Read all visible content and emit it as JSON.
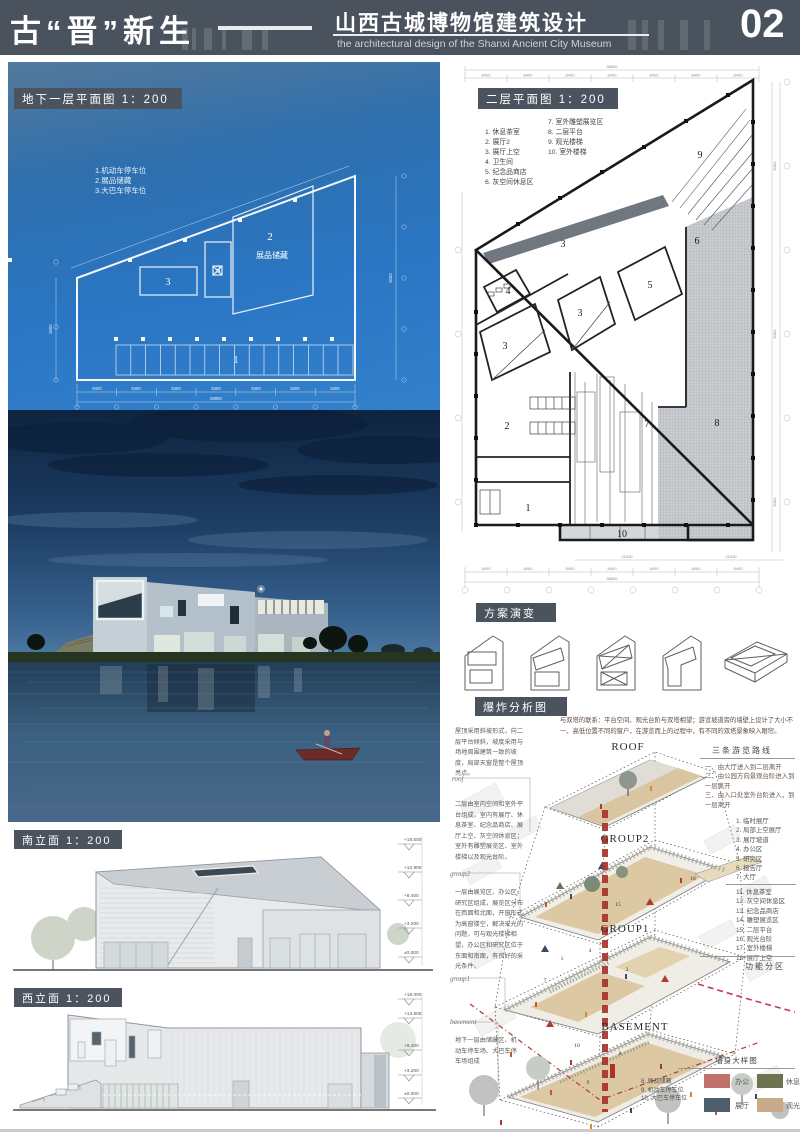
{
  "header": {
    "title_left": "古“晋”新生",
    "title_cn": "山西古城博物馆建筑设计",
    "title_en": "the architectural design of the Shanxi Ancient City Museum",
    "page_no": "02"
  },
  "basement_plan": {
    "label": "地下一层平面图 1：200",
    "legend": [
      "1.机动车停车位",
      "2.展品储藏",
      "3.大巴车停车位"
    ],
    "room2_name": "展品储藏",
    "numbers": {
      "r1": "1",
      "r2": "2",
      "r3a": "3",
      "r3b": "3"
    },
    "dims": {
      "bay": "8400",
      "total": "58800"
    }
  },
  "second_plan": {
    "label": "二层平面图 1：200",
    "legend_left": [
      "1. 休息茶室",
      "2. 展厅2",
      "3. 展厅上空",
      "4. 卫生间",
      "5. 纪念品商店",
      "6. 灰空间休息区"
    ],
    "legend_right": [
      "7. 室外雕塑展览区",
      "8. 二层平台",
      "9. 观光楼梯",
      "10. 室外楼梯"
    ],
    "numbers": {
      "n1": "1",
      "n2": "2",
      "n3a": "3",
      "n3b": "3",
      "n3c": "3",
      "n4": "4",
      "n5": "5",
      "n6": "6",
      "n7": "7",
      "n8": "8",
      "n9": "9",
      "n10": "10"
    },
    "dims": {
      "bay": "8400",
      "total": "58800",
      "sub": "21000"
    }
  },
  "evolution": {
    "label": "方案演变"
  },
  "explosion": {
    "label": "爆炸分析图",
    "intro": "与双塔的联系：平台空间、观光台阶与双塔相望；游览坡道旁的墙壁上设计了大小不一、高低位置不同的窗户，在游览而上的过程中，有不同的双塔景象映入眼帘。",
    "notes": {
      "roof": "屋顶采用斜坡形式，向二层平台倾斜，坡度采用与场地周围建筑一致的坡度，局部天窗是整个屋顶亮点。",
      "group2": "二层由室内空间和室外平台组成，室内有展厅、休息茶室、纪念品商店、展厅上空、灰空间休息区；室外有雕塑展览区、室外楼梯以及观光台阶。",
      "group1": "一层由展览区、办公区、研究区组成，展览区分布在西面和北面，开窗形式为高窗镂空，解决采光的问题，可与观光楼梯相望，办公区和研究区位于东面和南面，有良好的采光条件。",
      "basement": "地下一层由储藏区、机动车停车场、大巴车停车场组成"
    },
    "tags": {
      "roof": "roof",
      "group2": "group2",
      "group1": "group1",
      "basement": "basement"
    },
    "layers": [
      "ROOF",
      "GROUP2",
      "GROUP1",
      "BASEMENT"
    ],
    "routes": {
      "title": "三条游览路线",
      "items": [
        "一、由大厅进入到二层离开",
        "二、由公园方向景观台阶进入到一层离开",
        "三、由入口处室外台阶进入，到一层离开"
      ]
    },
    "zones": {
      "group_a": [
        "1. 临时展厅",
        "2. 局部上空展厅",
        "3. 展厅坡道",
        "4. 办公区",
        "5. 研究区",
        "6. 报告厅",
        "7. 大厅"
      ],
      "group_b": [
        "11. 休息茶室",
        "12. 灰空间休息区",
        "13. 纪念品商店",
        "14. 雕塑展览区",
        "15. 二层平台",
        "16. 观光台阶",
        "17. 室外楼梯",
        "18. 展厅上空"
      ],
      "group_c": [
        "8. 展品储藏",
        "9. 机动车停车位",
        "10. 大巴车停车位"
      ],
      "footer": "功能分区"
    },
    "slab_numbers": {
      "p15": "15",
      "p16": "16",
      "g1": "1",
      "g2": "2",
      "g4": "4",
      "g7": "7",
      "b8": "8",
      "b9": "9",
      "b10": "10"
    },
    "legend": {
      "title": "墙身大样图",
      "items": [
        {
          "label": "办公",
          "color": "#c2706a"
        },
        {
          "label": "休息",
          "color": "#6b7350"
        },
        {
          "label": "展厅",
          "color": "#4e5d6b"
        },
        {
          "label": "观光",
          "color": "#c8a988"
        }
      ]
    }
  },
  "south_elevation": {
    "label": "南立面 1：200",
    "marks": [
      "+18.000",
      "+12.900",
      "+8.400",
      "+3.200",
      "±0.000"
    ]
  },
  "west_elevation": {
    "label": "西立面 1：200",
    "marks": [
      "+18.000",
      "+13.800",
      "+8.400",
      "+3.200",
      "±0.000"
    ]
  }
}
